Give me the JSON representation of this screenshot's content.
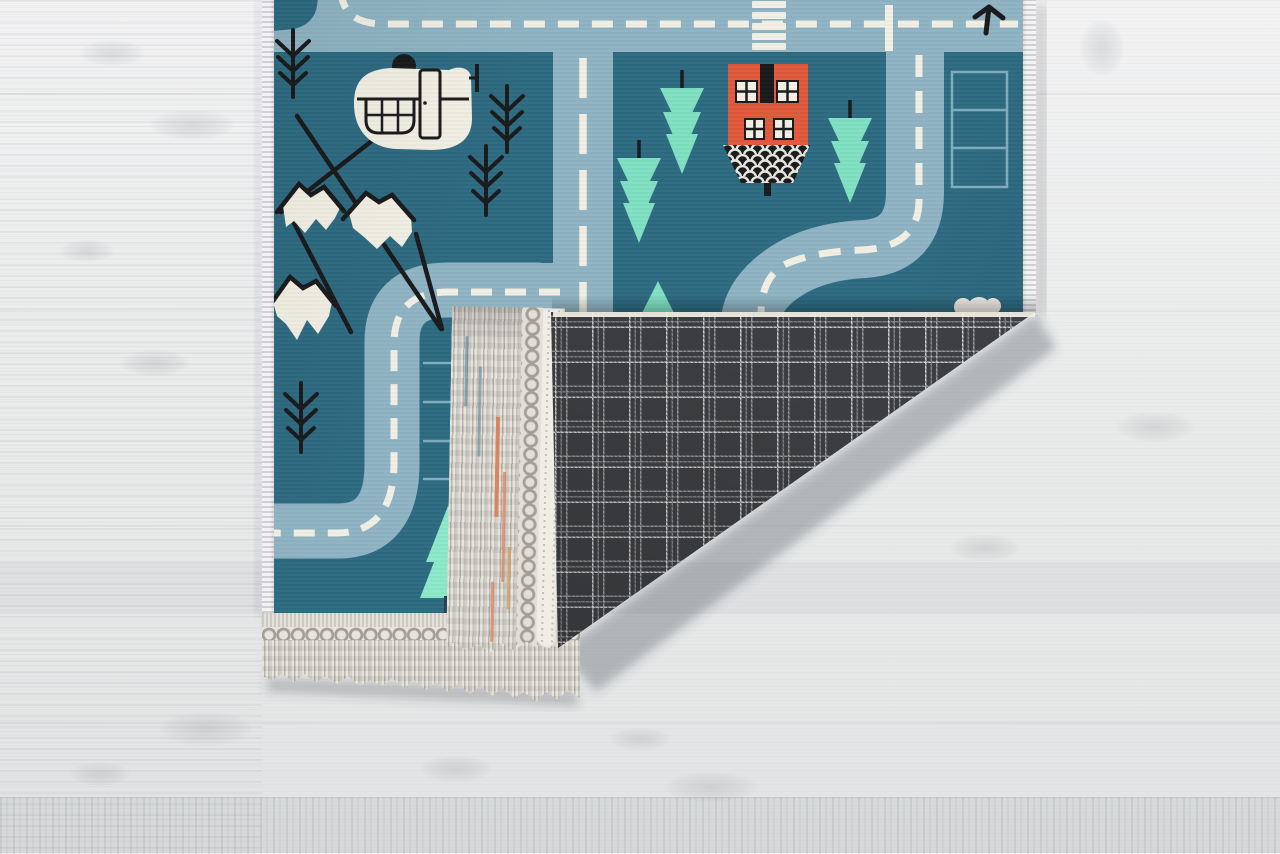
{
  "scene": {
    "type": "product-photo",
    "subject": "Kids teal road play rug with bottom-right corner folded over, showing charcoal plaid backing and ivory tassel fringe, lying on a whitewashed wood floor"
  },
  "colors": {
    "teal": "#2d6a81",
    "road": "#8fb4c3",
    "ivory": "#f2efe3",
    "mint": "#7fe0c2",
    "mint_light": "#8ce9c9",
    "ink": "#191a1c",
    "house_orange": "#e05a3b",
    "trunk_navy": "#274059",
    "parking": "#7eadbf",
    "plaid_base": "#3f4043",
    "plaid_line": "#ececee",
    "fringe_light": "#e4e1da",
    "fringe_mid": "#c3c0b8",
    "fringe_dark": "#a39f97",
    "fringe_orange": "#d97a52",
    "fringe_tan": "#c9a06b",
    "binding": "#efede6",
    "border": "#f3f2f4",
    "wood": "#ebecec",
    "wood_hi": "#f2f2f3",
    "wood_lo": "#e2e3e4",
    "cloud": "#f0ede4"
  },
  "rug": {
    "front_theme": "town road map with dashed-line streets",
    "backing_pattern": "charcoal windowpane plaid",
    "fringe_style": "knotted ivory tassel fringe with orange accent threads",
    "motifs": [
      "dashed roads",
      "pedestrian crossing",
      "parking spaces",
      "inverted-triangle mint trees",
      "pine tree",
      "fir twigs",
      "snow-capped mountain line art",
      "helicopter",
      "red house with scalloped hedge",
      "direction arrow",
      "cloud"
    ]
  },
  "floor": {
    "material": "whitewashed wood planks"
  }
}
